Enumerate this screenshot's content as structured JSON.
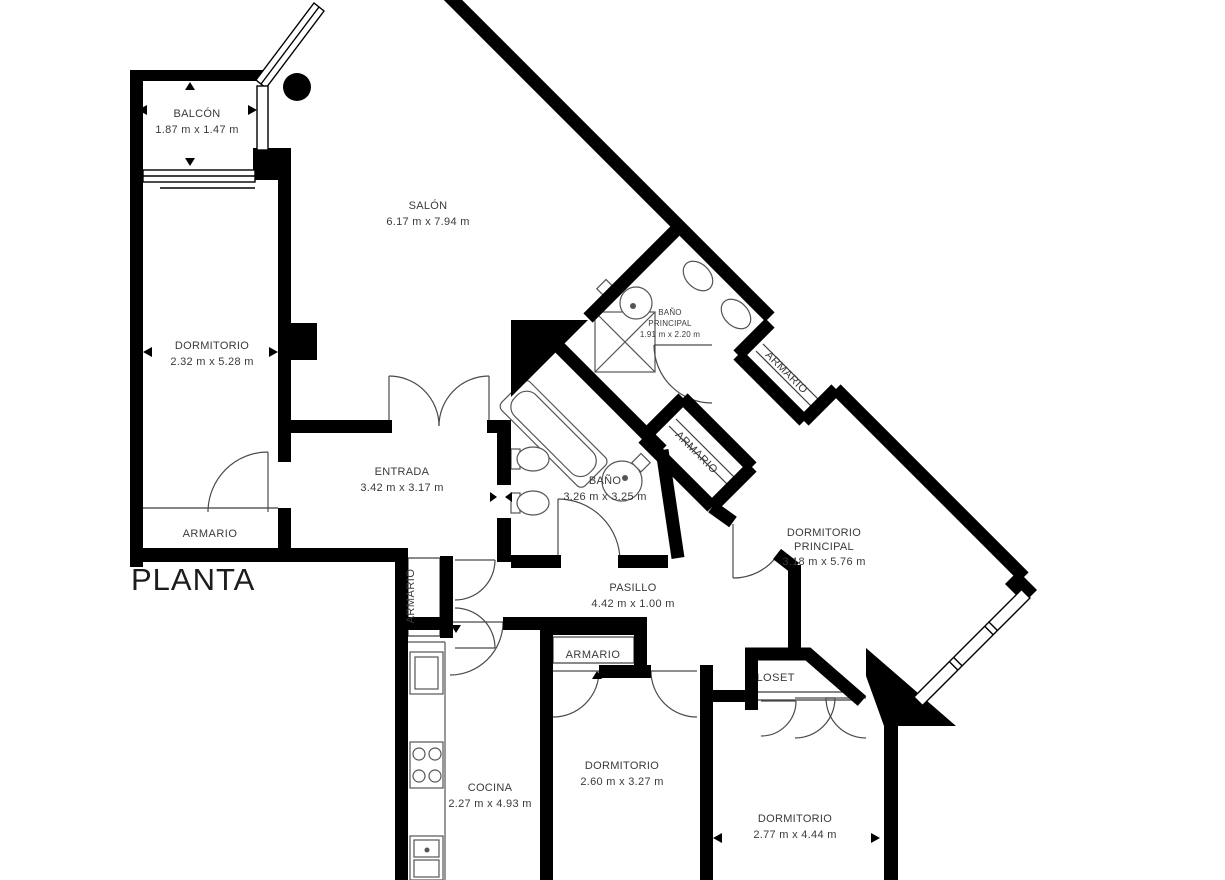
{
  "page": {
    "title": "PLANTA",
    "background": "#ffffff"
  },
  "palette": {
    "wall": "#000000",
    "thin_line": "#3c3c3c",
    "label_text": "#3a3a3a",
    "title_text": "#1c1c1c"
  },
  "rooms": [
    {
      "id": "balcon",
      "name": "BALCÓN",
      "dims": "1.87 m x 1.47 m"
    },
    {
      "id": "salon",
      "name": "SALÓN",
      "dims": "6.17 m x 7.94 m"
    },
    {
      "id": "dormitorio",
      "name": "DORMITORIO",
      "dims": "2.32 m x 5.28 m"
    },
    {
      "id": "bano-principal",
      "line1": "BAÑO",
      "line2": "PRINCIPAL",
      "dims": "1.91 m x 2.20 m"
    },
    {
      "id": "bano",
      "name": "BAÑO",
      "dims": "3.26 m x 3.25 m"
    },
    {
      "id": "entrada",
      "name": "ENTRADA",
      "dims": "3.42 m x 3.17 m"
    },
    {
      "id": "pasillo",
      "name": "PASILLO",
      "dims": "4.42 m x 1.00 m"
    },
    {
      "id": "dormitorio-principal",
      "line1": "DORMITORIO",
      "line2": "PRINCIPAL",
      "dims": "3.18 m x 5.76 m"
    },
    {
      "id": "cocina",
      "name": "COCINA",
      "dims": "2.27 m x 4.93 m"
    },
    {
      "id": "dormitorio-2",
      "name": "DORMITORIO",
      "dims": "2.60 m x 3.27 m"
    },
    {
      "id": "dormitorio-3",
      "name": "DORMITORIO",
      "dims": "2.77 m x 4.44 m"
    }
  ],
  "storage": {
    "armario": "ARMARIO",
    "closet": "CLOSET"
  }
}
